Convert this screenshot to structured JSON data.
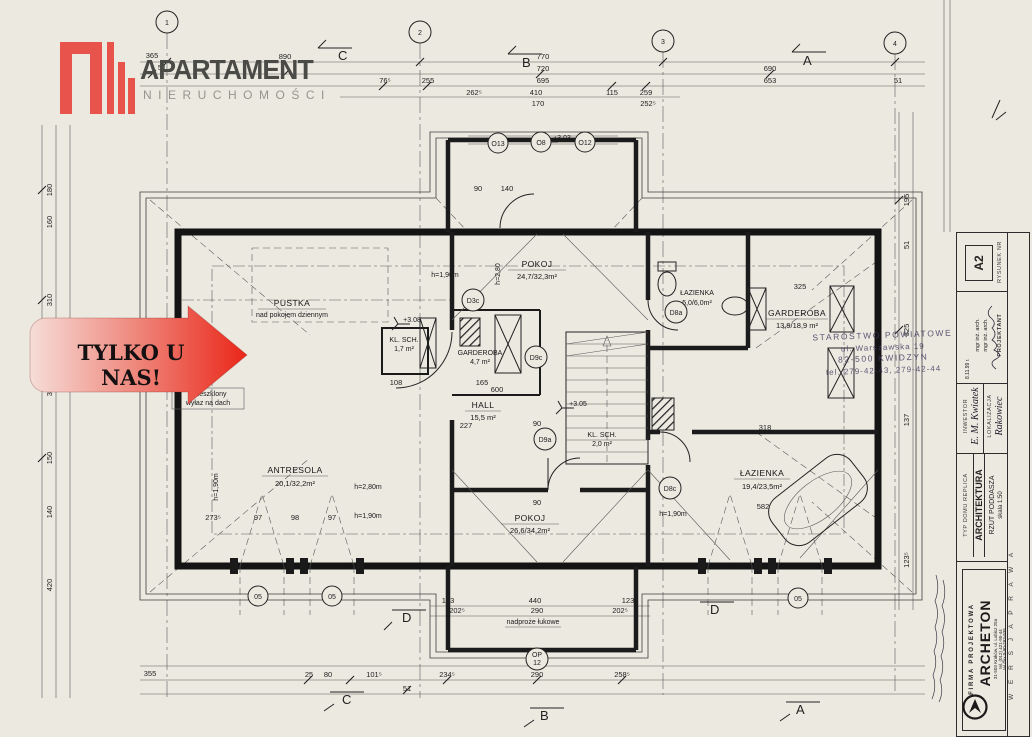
{
  "branding": {
    "title": "APARTAMENT",
    "subtitle": "NIERUCHOMOŚCI",
    "banner": "TYLKO U NAS!",
    "accent": "#e8544b"
  },
  "grid": {
    "bubbles": [
      "1",
      "2",
      "3",
      "4"
    ],
    "sections_top": [
      "C",
      "B",
      "A"
    ],
    "sections_bottom": [
      "D",
      "D",
      "C",
      "B",
      "A"
    ]
  },
  "rooms": [
    {
      "name": "PUSTKA",
      "area": "nad pokojem dziennym"
    },
    {
      "name": "ANTRESOLA",
      "area": "20,1/32,2m²"
    },
    {
      "name": "HALL",
      "area": "15,5 m²"
    },
    {
      "name": "POKOJ",
      "area": "24,7/32,3m²"
    },
    {
      "name": "POKOJ",
      "area": "26,6/34,2m²"
    },
    {
      "name": "GARDEROBA",
      "area": "4,7 m²"
    },
    {
      "name": "GARDEROBA",
      "area": "13,9/18,9 m²"
    },
    {
      "name": "ŁAZIENKA",
      "area": "5,0/6,0m²"
    },
    {
      "name": "ŁAZIENKA",
      "area": "19,4/23,5m²"
    },
    {
      "name": "KL. SCH.",
      "area": "1,7 m²"
    },
    {
      "name": "KL. SCH.",
      "area": "2,0 m²"
    }
  ],
  "annotations": {
    "hatch1": "przeszklony",
    "hatch2": "wyłaz na dach",
    "lintel": "nadproże łukowe",
    "h280a": "h=2,80m",
    "h190a": "h=1,90m",
    "h280b": "h=2,80",
    "h190b": "h=1,90m",
    "h190c": "h=1,90m",
    "h190d": "h=1,90m",
    "lvl308": "+3.08",
    "lvl305": "+3.05",
    "lvl303": "+3.03"
  },
  "refs": [
    "D3c",
    "D9c",
    "D9a",
    "D8a",
    "D8c",
    "O13",
    "O8",
    "O12",
    "05",
    "05",
    "05",
    "OP",
    "12"
  ],
  "dims": {
    "top": [
      "365",
      "51",
      "890",
      "76⁵",
      "255",
      "262⁵",
      "770",
      "720",
      "695",
      "410",
      "170",
      "115",
      "259",
      "252⁵",
      "690",
      "653",
      "51"
    ],
    "bottom": [
      "355",
      "25",
      "80",
      "101⁵",
      "51",
      "234⁵",
      "290",
      "258⁵",
      "123",
      "202⁵",
      "440",
      "290",
      "123",
      "202⁵"
    ],
    "left": [
      "180",
      "160",
      "310",
      "370",
      "150",
      "140",
      "420"
    ],
    "right": [
      "195",
      "51",
      "325",
      "137",
      "123⁵"
    ],
    "inner": [
      "600",
      "227",
      "90",
      "165",
      "108",
      "325",
      "318",
      "582",
      "97",
      "98",
      "97",
      "273⁵",
      "140",
      "90",
      "90"
    ]
  },
  "stamp": {
    "l1": "STAROSTWO POWIATOWE",
    "l2": "ul. Warszawska 19",
    "l3": "82-500 KWIDZYN",
    "l4": "tel. 279-42-43, 279-42-44"
  },
  "titleblock": {
    "no_label": "RYSUNEK NR",
    "no": "A2",
    "designer_label": "PROJEKTANT",
    "designer1": "mgr inż. arch.",
    "designer2": "mgr inż. arch.",
    "date": "8.11.99 r.",
    "investor_label": "INWESTOR",
    "investor": "E. M. Kwiatek",
    "location_label": "LOKALIZACJA",
    "location": "Rakowiec",
    "type": "TYP DOMU REPLICA",
    "branch": "ARCHITEKTURA",
    "sheet": "RZUT PODDASZA",
    "scale": "skala 1:50",
    "firm_label": "FIRMA PROJEKTOWA",
    "firm": "ARCHETON",
    "addr1": "31-503 Kraków, ul. Lubicz 25a",
    "addr2": "tel. (012) 421-95-44",
    "addr3": "tel./fax 0-90-293-936",
    "version": "W E R S J A   P R A W A"
  }
}
